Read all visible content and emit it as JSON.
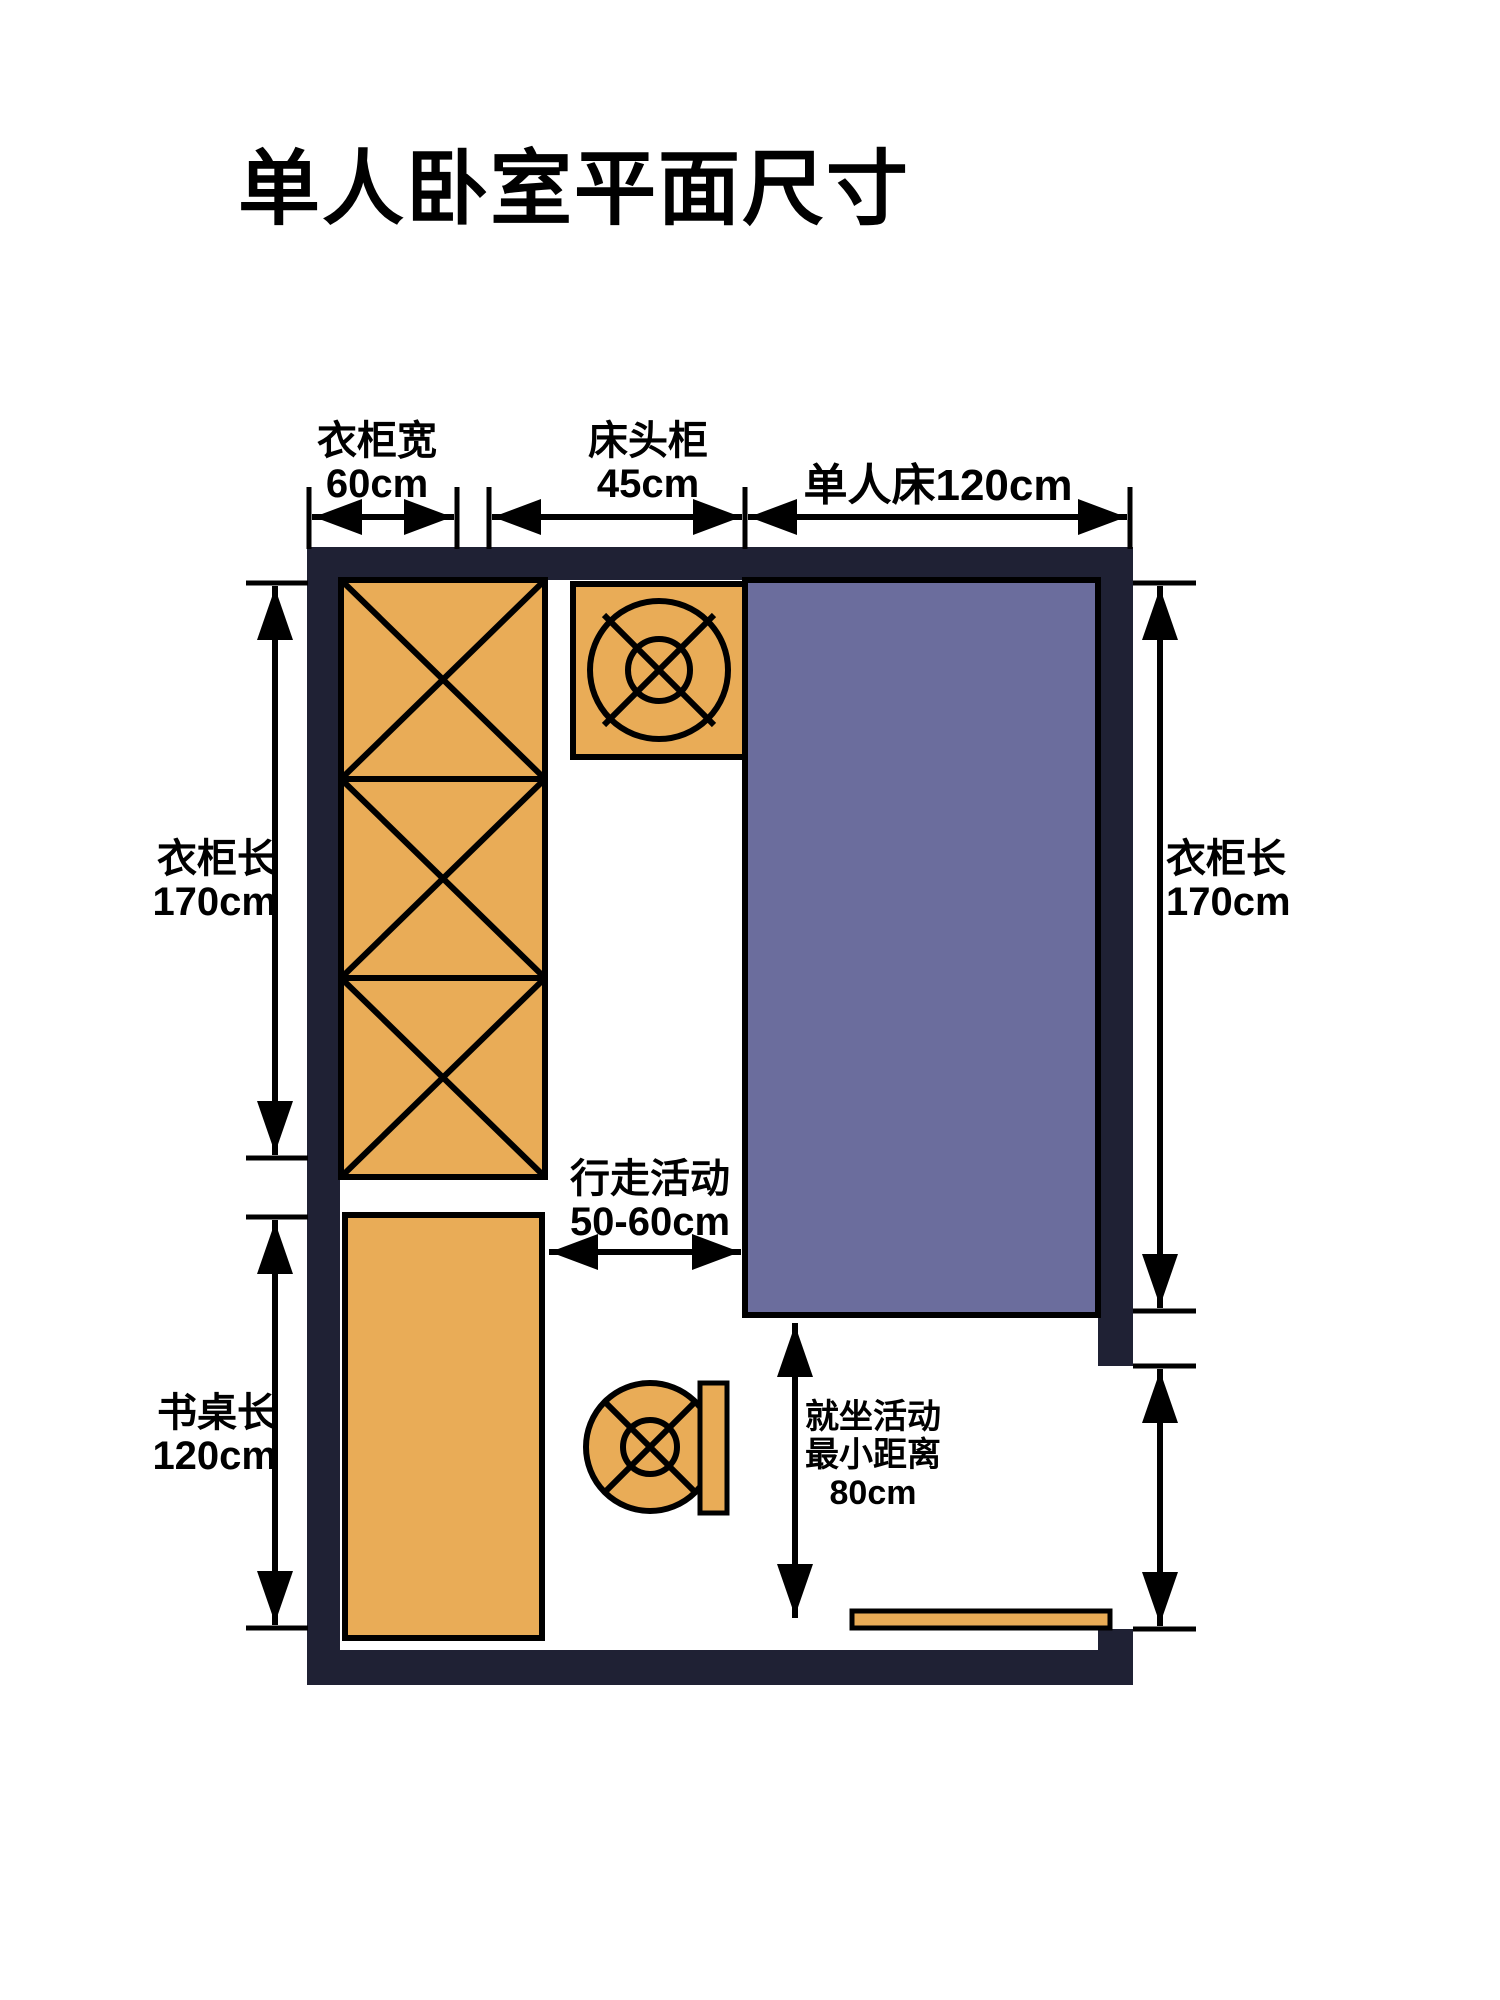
{
  "title": "单人卧室平面尺寸",
  "colors": {
    "wall": "#1f2134",
    "furniture": "#e9ac57",
    "bed": "#6b6d9d",
    "line": "#000000",
    "bg": "#ffffff"
  },
  "labels": {
    "wardrobe_width": {
      "name": "衣柜宽",
      "value": "60cm"
    },
    "nightstand_width": {
      "name": "床头柜",
      "value": "45cm"
    },
    "single_bed": {
      "name": "单人床120cm"
    },
    "wardrobe_length_left": {
      "name": "衣柜长",
      "value": "170cm"
    },
    "wardrobe_length_right": {
      "name": "衣柜长",
      "value": "170cm"
    },
    "desk_length": {
      "name": "书桌长",
      "value": "120cm"
    },
    "walking_clearance": {
      "name": "行走活动",
      "value": "50-60cm"
    },
    "seating_clearance": {
      "line1": "就坐活动",
      "line2": "最小距离",
      "value": "80cm"
    }
  }
}
